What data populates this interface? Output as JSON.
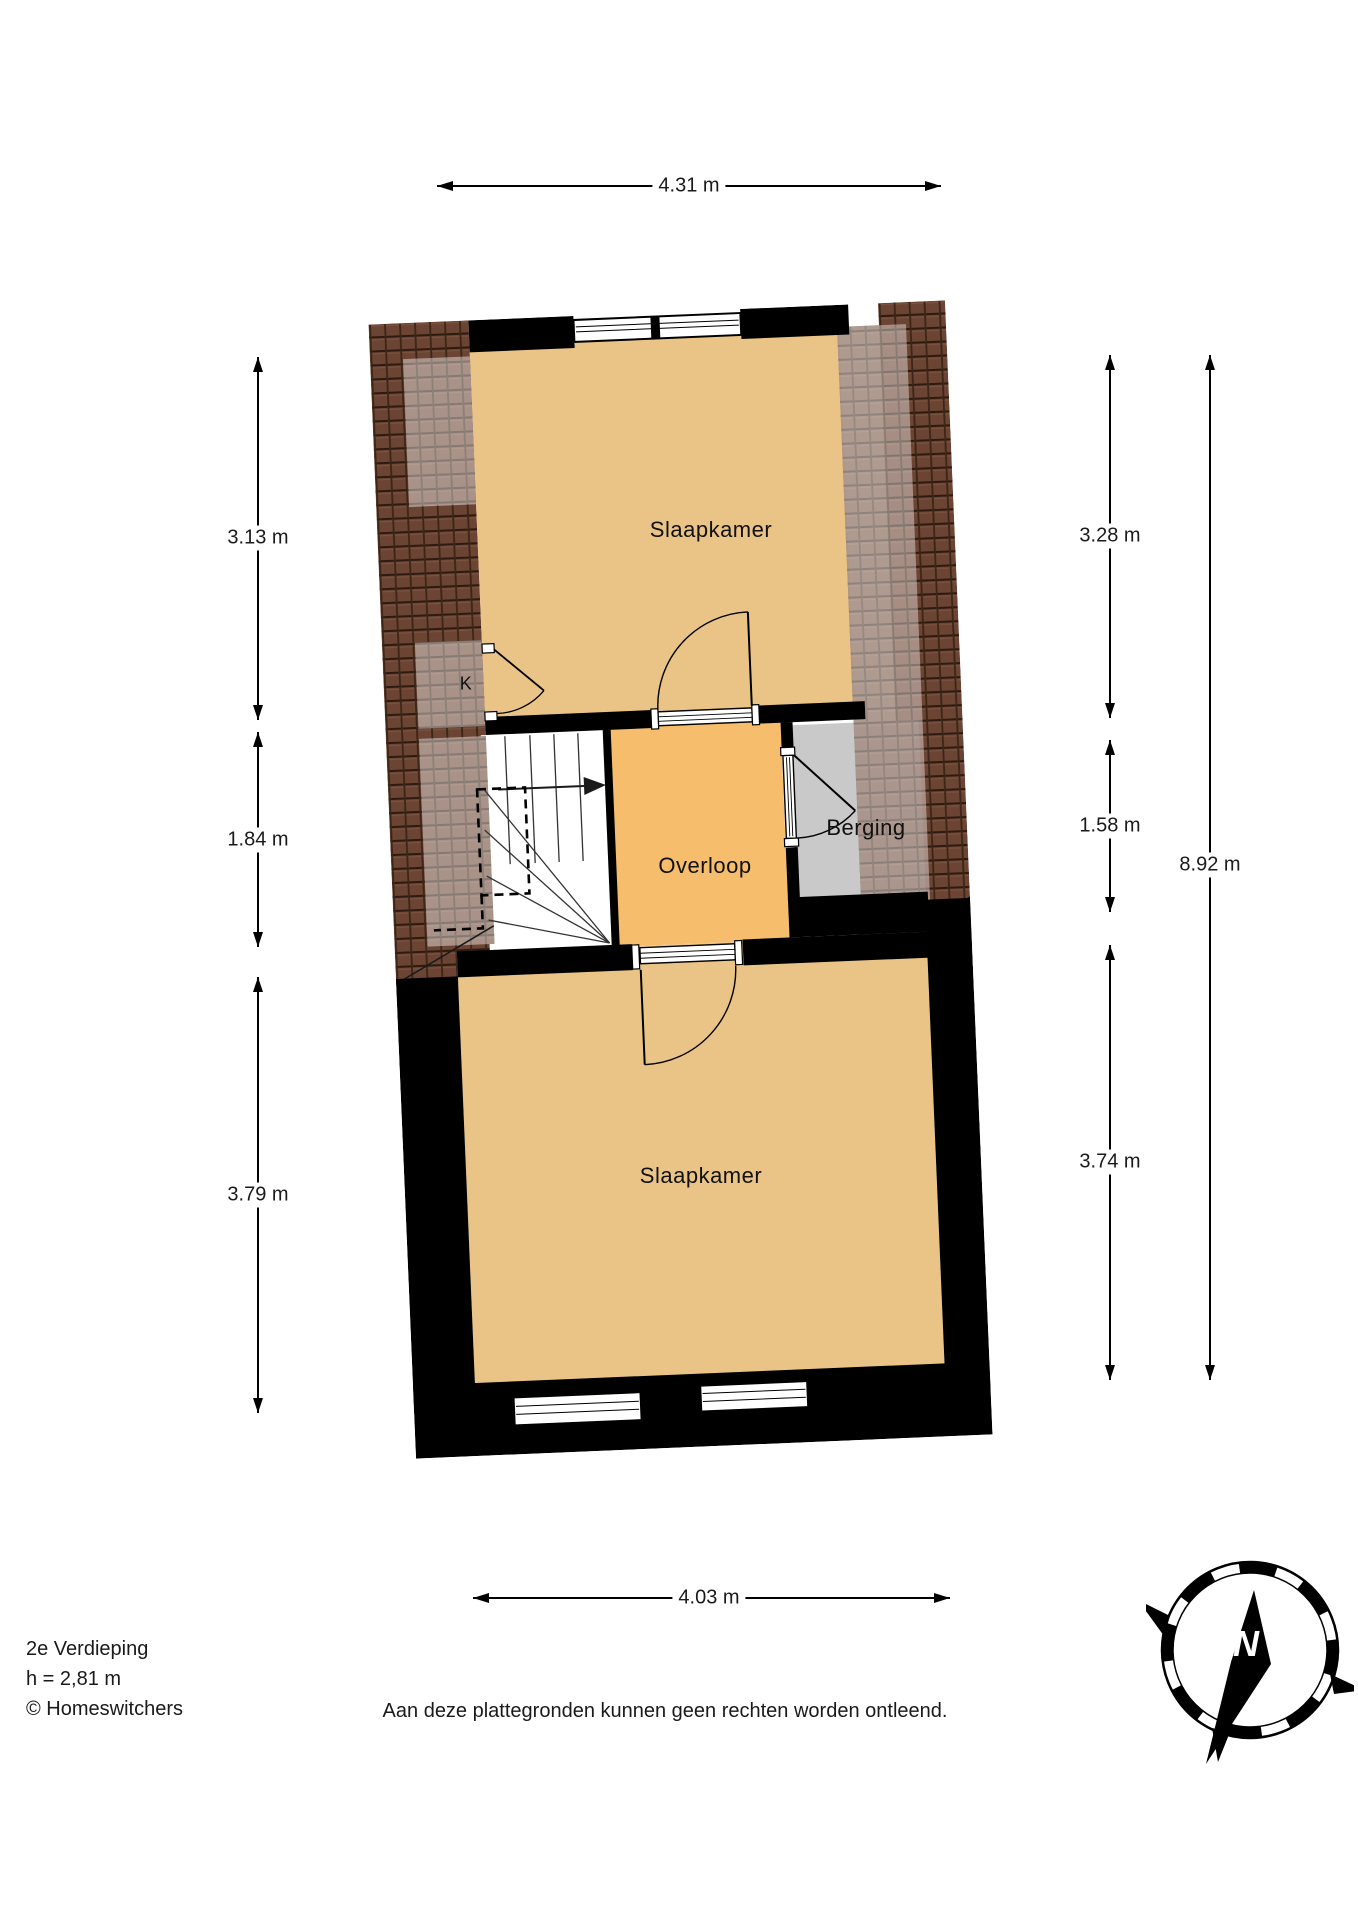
{
  "title_block": {
    "floor": "2e Verdieping",
    "ceiling_height": "h = 2,81 m",
    "copyright": "© Homeswitchers"
  },
  "disclaimer": "Aan deze plattegronden kunnen geen rechten worden ontleend.",
  "rooms": {
    "bedroom_top": "Slaapkamer",
    "bedroom_bottom": "Slaapkamer",
    "landing": "Overloop",
    "storage": "Berging",
    "closet": "K"
  },
  "dimensions": {
    "top": "4.31 m",
    "bottom": "4.03 m",
    "left": [
      {
        "label": "3.13 m"
      },
      {
        "label": "1.84 m"
      },
      {
        "label": "3.79 m"
      }
    ],
    "right": [
      {
        "label": "3.28 m"
      },
      {
        "label": "1.58 m"
      },
      {
        "label": "3.74 m"
      }
    ],
    "overall_right": "8.92 m"
  },
  "compass": {
    "north": "N"
  },
  "colors": {
    "room_orange": "#eac487",
    "landing_orange": "#f6bd6c",
    "storage_gray": "#c9c9c9",
    "wall_black": "#000000",
    "roof_tile": "#6b4433"
  }
}
